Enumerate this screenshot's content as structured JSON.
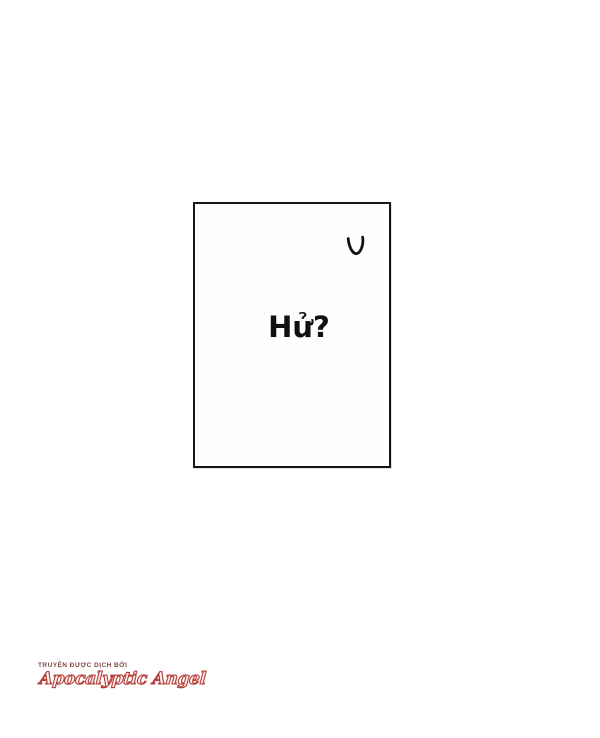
{
  "canvas": {
    "width": 600,
    "height": 738,
    "background": "#ffffff"
  },
  "panel": {
    "dialogue_text": "Hử?",
    "border_color": "#161616",
    "mark_icon": "v-doodle",
    "ink_color": "#111111"
  },
  "watermark": {
    "credit_line": "TRUYỆN ĐƯỢC DỊCH BỞI",
    "group_name": "Apocalyptic Angel",
    "credit_color": "#7d4b43",
    "group_color": "#b5403d"
  }
}
